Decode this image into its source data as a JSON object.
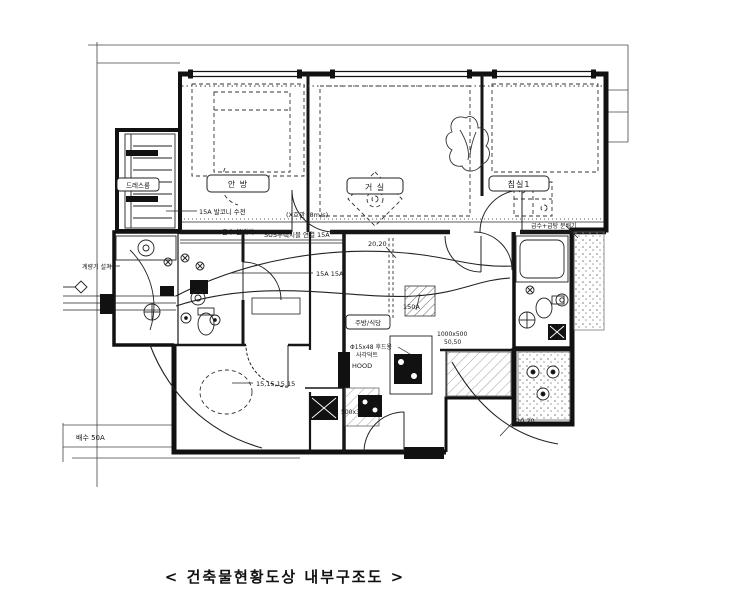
{
  "colors": {
    "ink": "#161616",
    "paper": "#ffffff"
  },
  "caption": "< 건축물현황도상 내부구조도 >",
  "rooms": {
    "dress_room": "드레스룸",
    "master_bedroom": "안 방",
    "living_room": "거 실",
    "bedroom1": "침실1",
    "kitchen_dining": "주방/식당"
  },
  "annotations": {
    "balcony_faucet": "15A 발코니 수전",
    "riser_pipe": "(X호관 (8m/s)",
    "hot_water_distributor": "온수 분배기",
    "sus_flexible": "SUS후렉시블 연결 15A",
    "dim_top": "20,20",
    "pipe_15a": "15A 15A",
    "duct_150a": "150A",
    "hood_duct": "Φ15x48 후드용",
    "hood_duct2": "사각덕트",
    "hood": "HOOD",
    "dim_1000x500": "1000x500",
    "dim_50_50": "50,50",
    "dim_15s": "15,15,15,15",
    "dim_500x300": "500x300",
    "drain_50a": "배수 50A",
    "dim_bottom": "20,20",
    "supply_distributor": "급수+급탕 분배기",
    "meter": "계량기 설치"
  }
}
